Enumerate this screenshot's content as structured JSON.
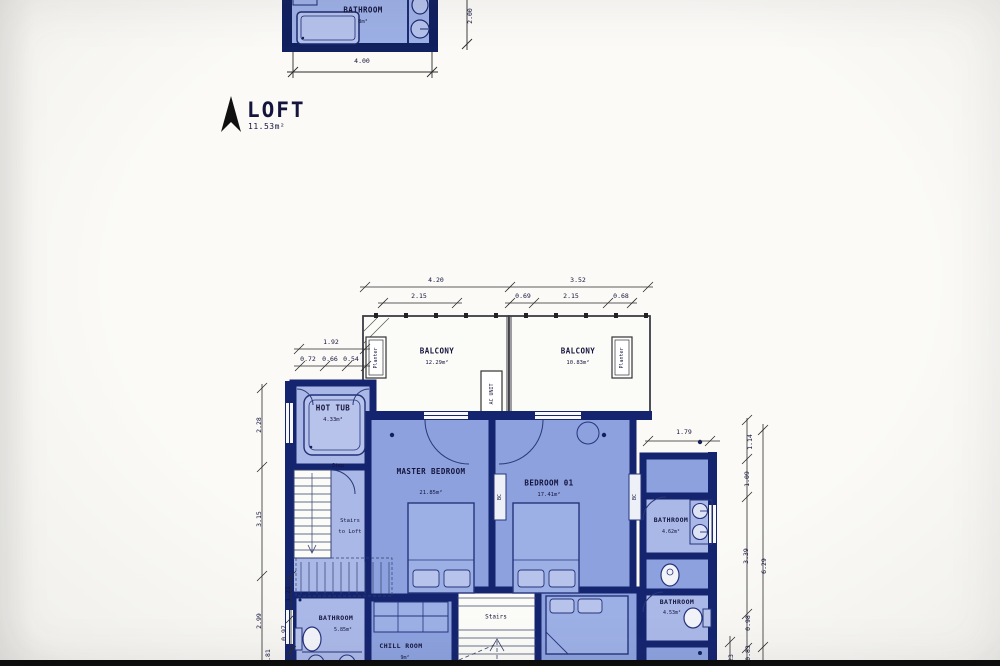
{
  "title": {
    "floor_label": "LOFT",
    "floor_area": "11.53m²"
  },
  "loft_plan": {
    "bathroom": {
      "name": "BATHROOM",
      "area": "8m²"
    },
    "dim_width": "4.00",
    "dim_height": "2.00"
  },
  "main_plan": {
    "rooms": {
      "balcony_left": {
        "name": "BALCONY",
        "area": "12.29m²"
      },
      "balcony_right": {
        "name": "BALCONY",
        "area": "10.83m²"
      },
      "hot_tub": {
        "name": "HOT TUB",
        "area": "4.33m²"
      },
      "master_bedroom": {
        "name": "MASTER BEDROOM",
        "area": "21.85m²"
      },
      "bedroom_01": {
        "name": "BEDROOM 01",
        "area": "17.41m²"
      },
      "bathroom_ensuite": {
        "name": "BATHROOM",
        "area": "4.62m²"
      },
      "bathroom_lower_right": {
        "name": "BATHROOM",
        "area": "4.53m²"
      },
      "bathroom_lower_left": {
        "name": "BATHROOM",
        "area": "5.85m²"
      },
      "chill_room": {
        "name": "CHILL ROOM",
        "area": "9m²"
      }
    },
    "annotations": {
      "planter": "Planter",
      "ac_unit": "AC UNIT",
      "closet": "BC",
      "step": "Step",
      "stairs": "Stairs",
      "stairs_to_loft_line1": "Stairs",
      "stairs_to_loft_line2": "to Loft"
    },
    "dimensions": {
      "top_outer": [
        "4.20",
        "3.52"
      ],
      "top_inner": [
        "2.15",
        "0.69",
        "2.15",
        "0.68"
      ],
      "left_upper": "1.92",
      "left_upper_inner": [
        "0.72",
        "0.66",
        "0.54"
      ],
      "left_outer": [
        "2.28",
        "3.15",
        "2.99",
        "0.81"
      ],
      "left_inner": [
        "1.21",
        "0.97"
      ],
      "right_wing_width": "1.79",
      "right_inner": [
        "1.14",
        "1.09",
        "3.39",
        "0.98",
        "0.83"
      ],
      "right_outer": "6.29",
      "right_partial": "23"
    }
  },
  "colors": {
    "wall": "#15246f",
    "room_medium": "#8ca1de",
    "room_light": "#aab8e8",
    "white_room": "#fbfbf8",
    "background": "#f7f6f3",
    "photo_bottom_bar": "#0b0b0b"
  }
}
